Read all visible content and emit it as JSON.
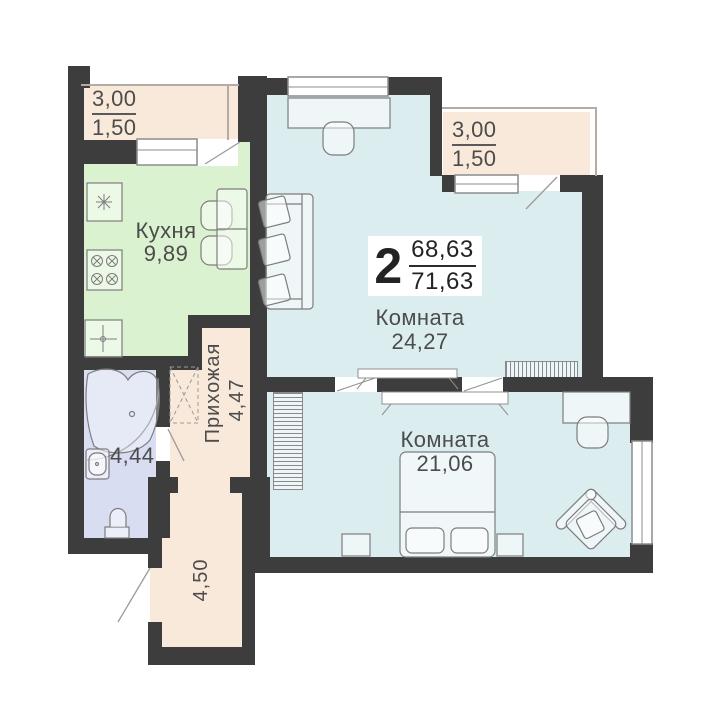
{
  "apartment": {
    "rooms_count": "2",
    "area_upper": "68,63",
    "area_total": "71,63"
  },
  "rooms": {
    "kitchen": {
      "name": "Кухня",
      "area": "9,89"
    },
    "living_room": {
      "name": "Комната",
      "area": "24,27"
    },
    "bedroom": {
      "name": "Комната",
      "area": "21,06"
    },
    "hallway": {
      "name": "Прихожая",
      "area": "4,47"
    },
    "bathroom": {
      "area": "4,44"
    },
    "corridor": {
      "area": "4,50"
    },
    "balcony_left": {
      "dimension": "3,00",
      "area": "1,50"
    },
    "balcony_right": {
      "dimension": "3,00",
      "area": "1,50"
    }
  },
  "colors": {
    "wall": "#3d3d3d",
    "kitchen_fill": "#daf2cf",
    "room_fill": "#dcedf0",
    "bathroom_fill": "#d9ddf2",
    "hall_balcony_fill": "#f9e9da",
    "label_text": "#4c4c4c"
  }
}
